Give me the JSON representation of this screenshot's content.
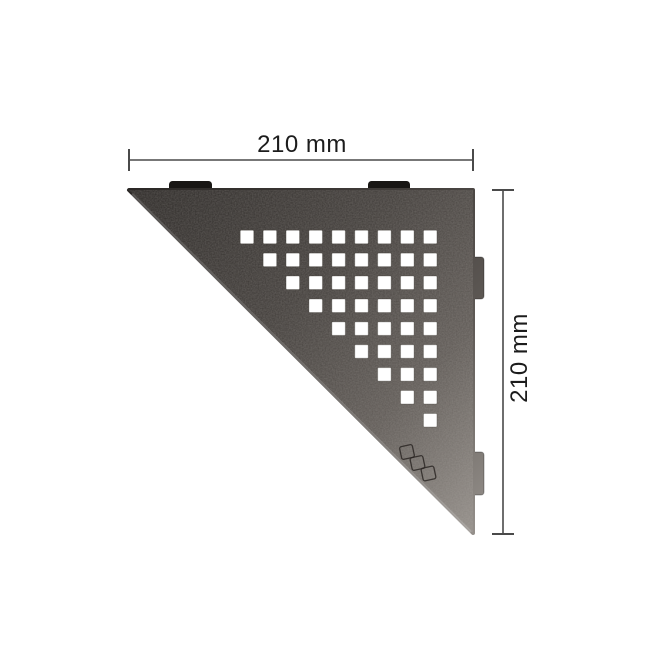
{
  "scene": {
    "background": "#ffffff",
    "description": "Technical product image: triangular corner shelf with square perforation pattern and dimension callouts"
  },
  "dimensions": {
    "top": {
      "label": "210 mm"
    },
    "right": {
      "label": "210 mm"
    }
  },
  "colors": {
    "dimension_line": "#4a4a4a",
    "dimension_text": "#1c1c1c",
    "shelf_gradient_dark": "#2b2826",
    "shelf_gradient_mid1": "#413d3a",
    "shelf_gradient_mid2": "#5f5a56",
    "shelf_gradient_light": "#948f8a",
    "mounting_tab_top": "#181614",
    "hole_fill": "#ffffff",
    "hole_edge": "rgba(60,55,50,0.30)",
    "tab_outline": "rgba(0,0,0,0.30)",
    "logo_stroke": "#2b2724",
    "hypotenuse_highlight": "rgba(255,255,255,0.20)"
  },
  "shelf": {
    "shape": "right-triangle",
    "corners": [
      [
        129,
        190
      ],
      [
        473,
        190
      ],
      [
        473,
        533
      ]
    ],
    "perforation": {
      "pattern": "staircase-right-aligned",
      "rows": 9,
      "cols": 9,
      "hole_count": 45,
      "square_size": 13.5,
      "pitch": 22.9,
      "first_col_center_x": 247,
      "first_row_center_y": 237
    },
    "mounting_tabs_top": [
      {
        "x": 169,
        "y": 181,
        "w": 43,
        "h": 13
      },
      {
        "x": 368,
        "y": 181,
        "w": 42,
        "h": 13
      }
    ],
    "mounting_tabs_right": [
      {
        "x": 472,
        "y": 257,
        "w": 12,
        "h": 42
      },
      {
        "x": 472,
        "y": 452,
        "w": 12,
        "h": 43
      }
    ],
    "logo_marks": [
      {
        "cx": 407,
        "cy": 452,
        "size": 13,
        "rot": -12
      },
      {
        "cx": 417.5,
        "cy": 463,
        "size": 13,
        "rot": -12
      },
      {
        "cx": 428.5,
        "cy": 473.5,
        "size": 13,
        "rot": -12
      }
    ]
  },
  "dimension_geometry": {
    "top": {
      "y": 160,
      "x1": 129,
      "x2": 473,
      "tick_half": 11,
      "label_x": 302,
      "label_y": 152
    },
    "right": {
      "x": 503,
      "y1": 190,
      "y2": 534,
      "tick_half": 11,
      "label_x": 527,
      "label_y": 358
    }
  }
}
